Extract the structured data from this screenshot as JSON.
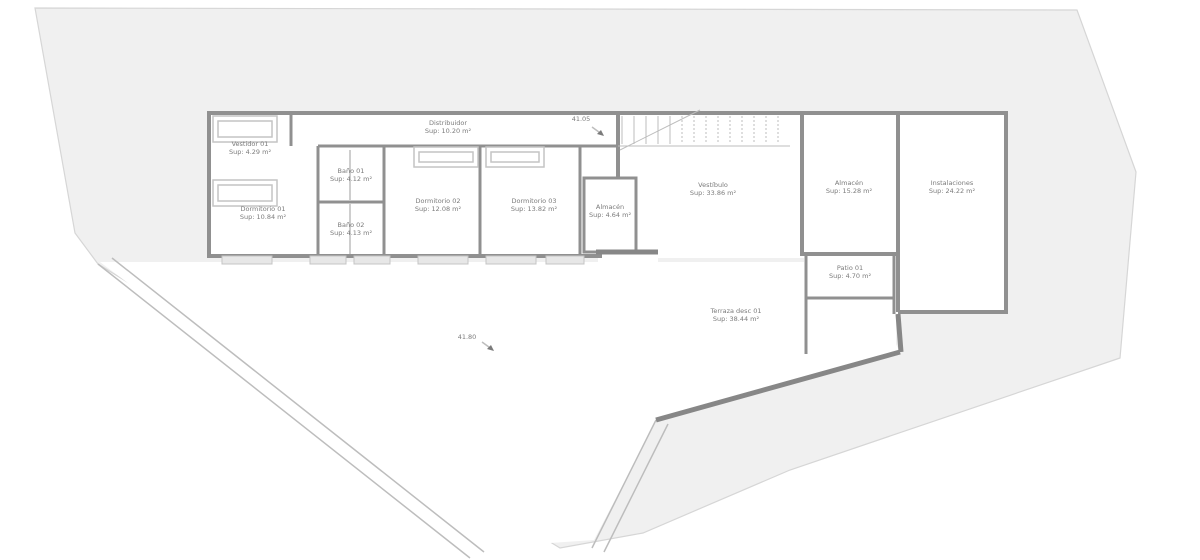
{
  "colors": {
    "site-fill": "#f0f0f0",
    "site-edge": "#d6d6d6",
    "wall": "#909090",
    "wall-dark": "#878787",
    "line-light": "#bdbdbd",
    "fixture": "#c4c4c4",
    "sill-fill": "#e7e7e7",
    "label-text": "#7b7b7b"
  },
  "plan": {
    "rooms": [
      {
        "id": "vestidor-01",
        "name": "Vestidor 01",
        "area": "Sup: 4.29 m²"
      },
      {
        "id": "dormitorio-01",
        "name": "Dormitorio 01",
        "area": "Sup: 10.84 m²"
      },
      {
        "id": "bano-01",
        "name": "Baño 01",
        "area": "Sup: 4.12 m²"
      },
      {
        "id": "bano-02",
        "name": "Baño 02",
        "area": "Sup: 4.13 m²"
      },
      {
        "id": "distribuidor",
        "name": "Distribuidor",
        "area": "Sup: 10.20 m²"
      },
      {
        "id": "dormitorio-02",
        "name": "Dormitorio 02",
        "area": "Sup: 12.08 m²"
      },
      {
        "id": "dormitorio-03",
        "name": "Dormitorio 03",
        "area": "Sup: 13.82 m²"
      },
      {
        "id": "almacen-01",
        "name": "Almacén",
        "area": "Sup: 4.64 m²"
      },
      {
        "id": "vestibulo",
        "name": "Vestíbulo",
        "area": "Sup: 33.86 m²"
      },
      {
        "id": "almacen-02",
        "name": "Almacén",
        "area": "Sup: 15.28 m²"
      },
      {
        "id": "instalaciones",
        "name": "Instalaciones",
        "area": "Sup: 24.22 m²"
      },
      {
        "id": "patio-01",
        "name": "Patio 01",
        "area": "Sup: 4.70 m²"
      },
      {
        "id": "terraza-01",
        "name": "Terraza desc 01",
        "area": "Sup: 38.44 m²"
      }
    ],
    "levels": [
      {
        "id": "level-upper",
        "label": "41.05"
      },
      {
        "id": "level-garden",
        "label": "41.80"
      }
    ]
  }
}
